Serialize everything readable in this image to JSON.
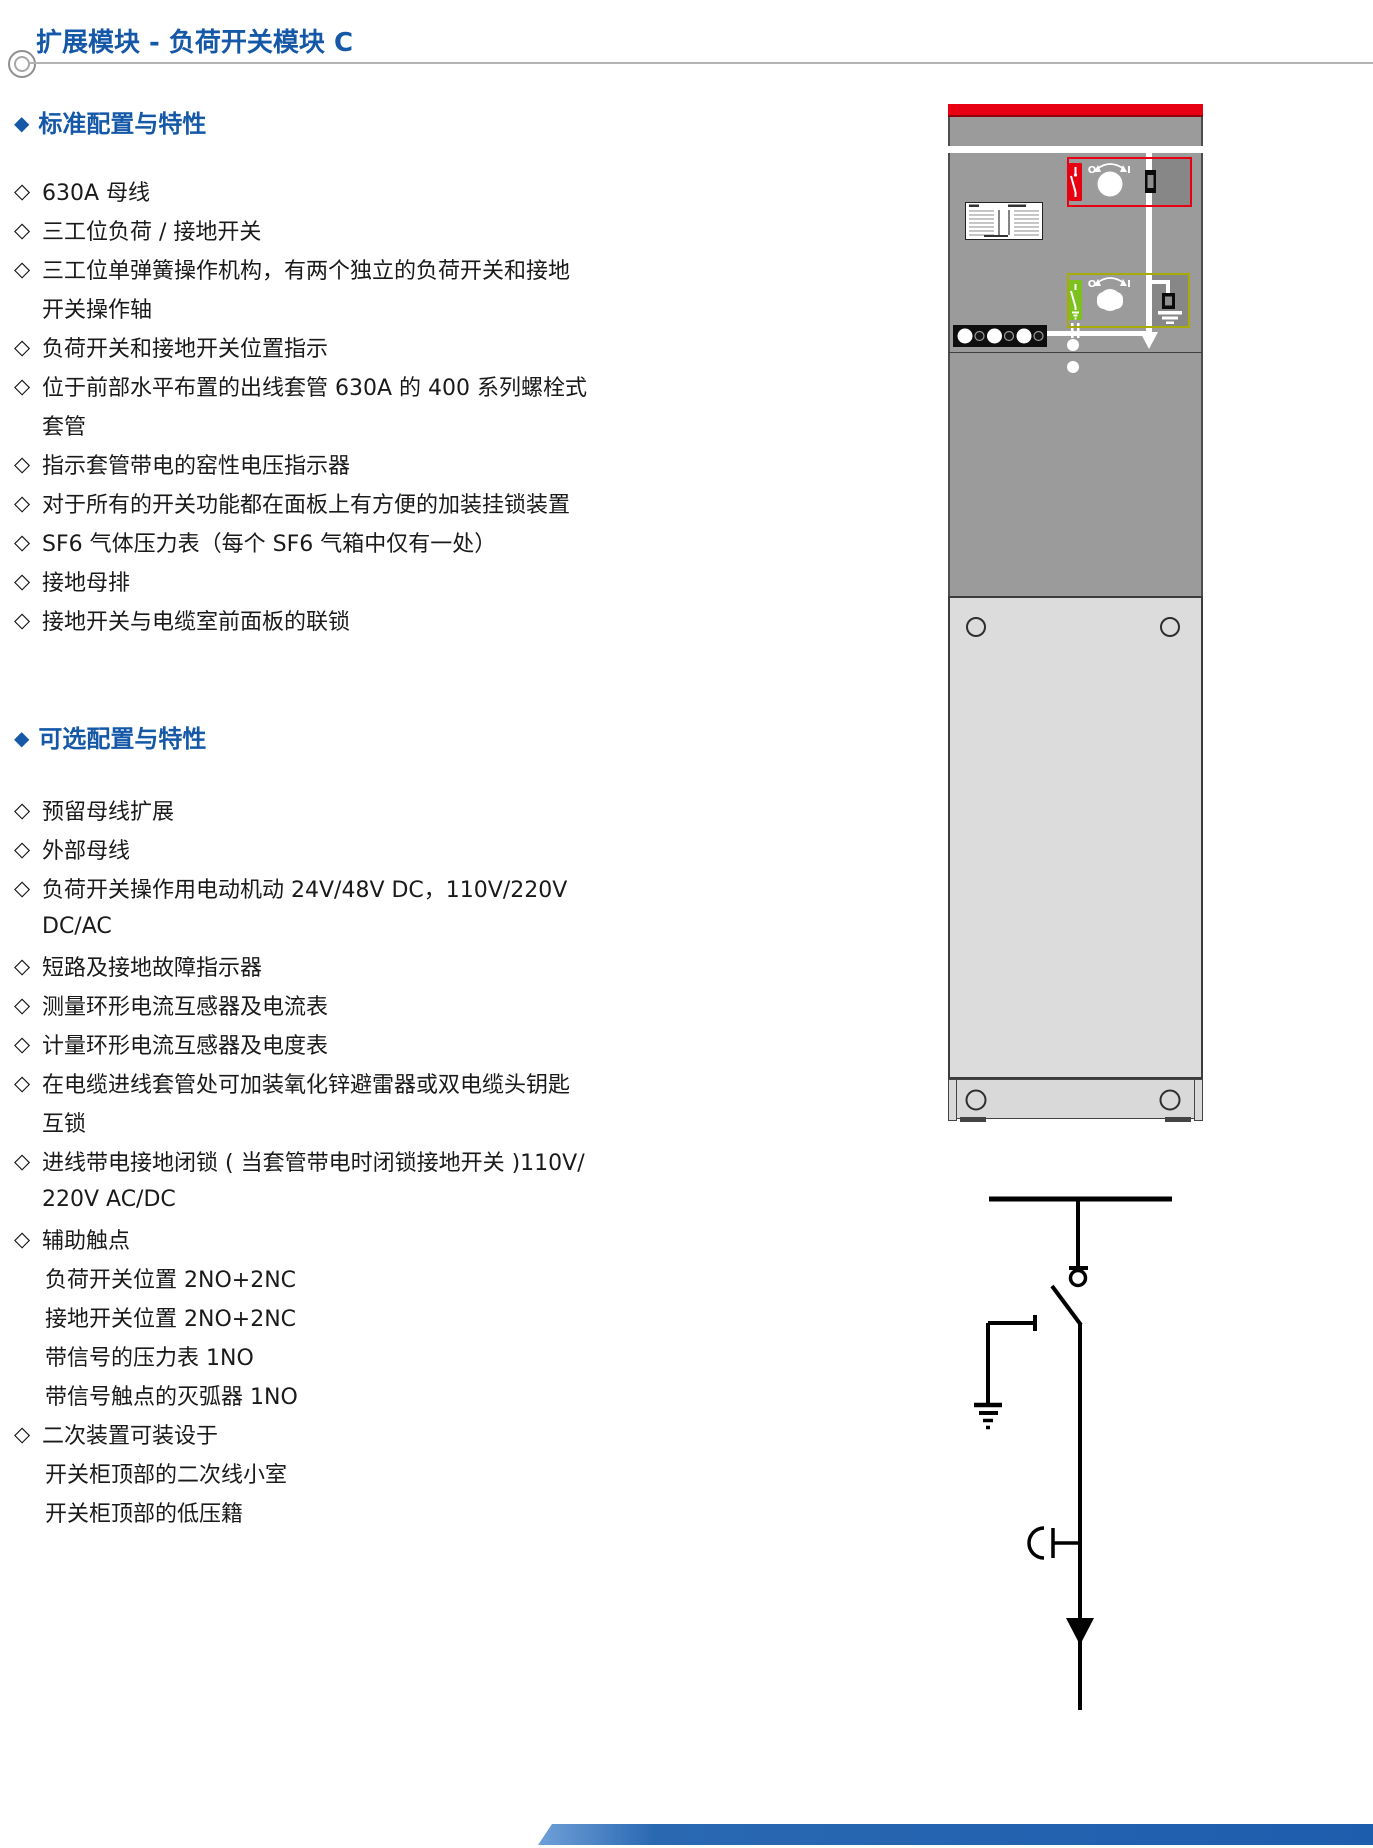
{
  "page": {
    "title": "扩展模块 - 负荷开关模块 C"
  },
  "icons": {
    "section_bullet": "◆",
    "item_bullet": "◇"
  },
  "standard": {
    "heading": "标准配置与特性",
    "lines": [
      "630A 母线",
      "三工位负荷 / 接地开关",
      "三工位单弹簧操作机构，有两个独立的负荷开关和接地",
      "开关操作轴",
      "负荷开关和接地开关位置指示",
      "位于前部水平布置的出线套管 630A 的 400 系列螺栓式",
      "套管",
      "指示套管带电的窑性电压指示器",
      "对于所有的开关功能都在面板上有方便的加装挂锁装置",
      "SF6 气体压力表（每个 SF6 气箱中仅有一处）",
      "接地母排",
      "接地开关与电缆室前面板的联锁"
    ]
  },
  "optional": {
    "heading": "可选配置与特性",
    "lines": [
      "预留母线扩展",
      "外部母线",
      "负荷开关操作用电动机动 24V/48V DC，110V/220V",
      "DC/AC",
      "短路及接地故障指示器",
      "测量环形电流互感器及电流表",
      "计量环形电流互感器及电度表",
      "在电缆进线套管处可加装氧化锌避雷器或双电缆头钥匙",
      "互锁",
      "进线带电接地闭锁 ( 当套管带电时闭锁接地开关 )110V/",
      "220V AC/DC",
      "辅助触点",
      "负荷开关位置 2NO+2NC",
      "接地开关位置 2NO+2NC",
      "带信号的压力表 1NO",
      "带信号触点的灭弧器 1NO",
      "二次装置可装设于",
      "开关柜顶部的二次线小室",
      "开关柜顶部的低压籍"
    ]
  },
  "cabinet": {
    "load_switch_panel": {
      "off_label": "O",
      "on_label": "I"
    },
    "earth_switch_panel": {
      "off_label": "O",
      "on_label": "I"
    }
  },
  "colors": {
    "accent_blue": "#1558a8",
    "alarm_red": "#e60012",
    "earth_green": "#7dc11f",
    "earth_frame_yellow": "#a9ab07",
    "cabinet_gray": "#9b9b9b",
    "door_gray": "#dcdcdc",
    "footer_blue": "#2a68b2"
  }
}
